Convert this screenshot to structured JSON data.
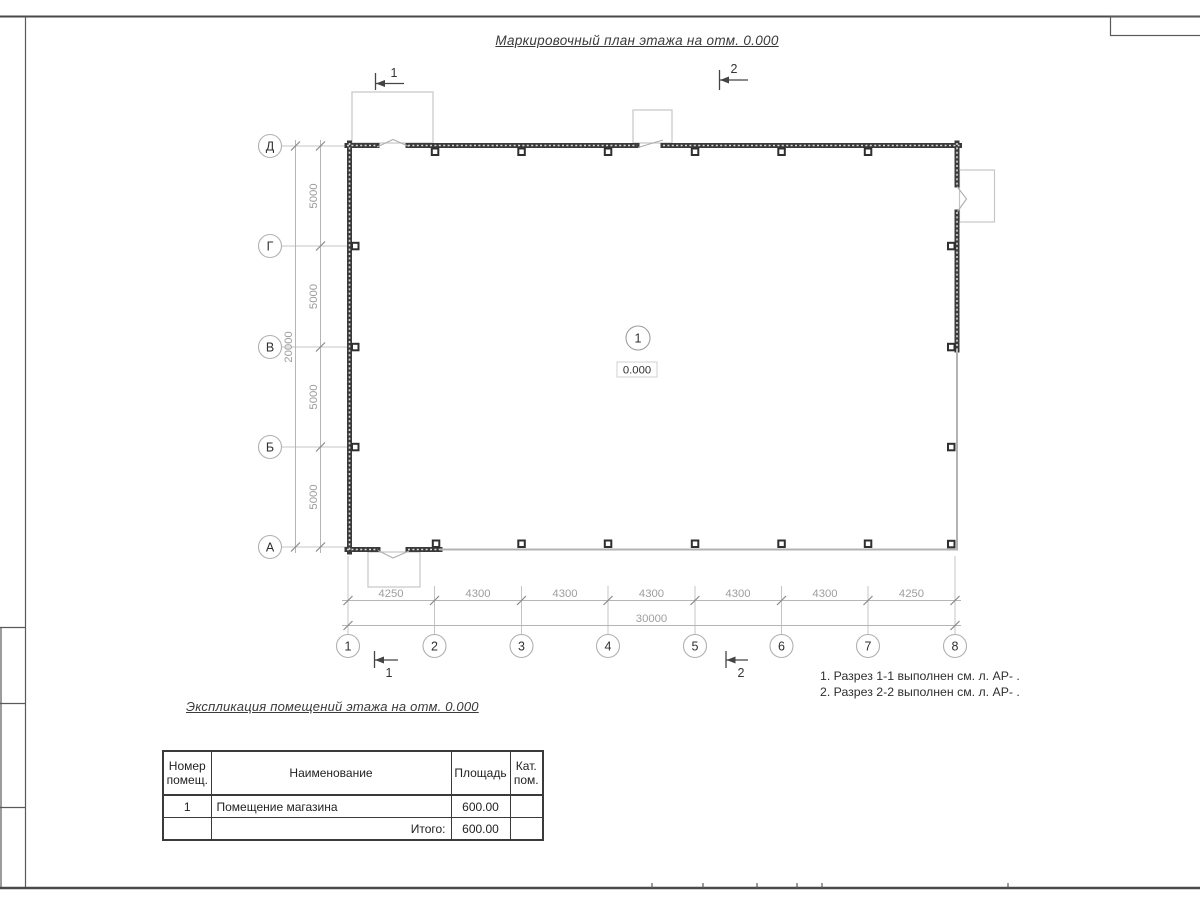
{
  "title": "Маркировочный план этажа на отм. 0.000",
  "notes": {
    "line1": "1. Разрез 1-1 выполнен см. л. АР- .",
    "line2": "2. Разрез 2-2 выполнен см. л. АР- ."
  },
  "plan": {
    "room": {
      "number": "1",
      "elevation": "0.000"
    },
    "axes_v": [
      "Д",
      "Г",
      "В",
      "Б",
      "А"
    ],
    "axes_h": [
      "1",
      "2",
      "3",
      "4",
      "5",
      "6",
      "7",
      "8"
    ],
    "dims_v": [
      "5000",
      "5000",
      "5000",
      "5000"
    ],
    "dim_v_total": "20000",
    "dims_h": [
      "4250",
      "4300",
      "4300",
      "4300",
      "4300",
      "4300",
      "4250"
    ],
    "dim_h_total": "30000",
    "sections": {
      "s1": "1",
      "s2": "2"
    }
  },
  "spec": {
    "title": "Экспликация помещений этажа на отм. 0.000",
    "col_number": "Номер помещ.",
    "col_name": "Наименование",
    "col_area": "Площадь",
    "col_cat": "Кат. пом.",
    "rows": [
      {
        "number": "1",
        "name": "Помещение магазина",
        "area": "600.00",
        "cat": ""
      }
    ],
    "total_label": "Итого:",
    "total_value": "600.00"
  },
  "colors": {
    "wall": "#3a3a3a",
    "line": "#b5b5b5",
    "dim_text": "#9e9e9e",
    "ink": "#2f2f2f"
  }
}
